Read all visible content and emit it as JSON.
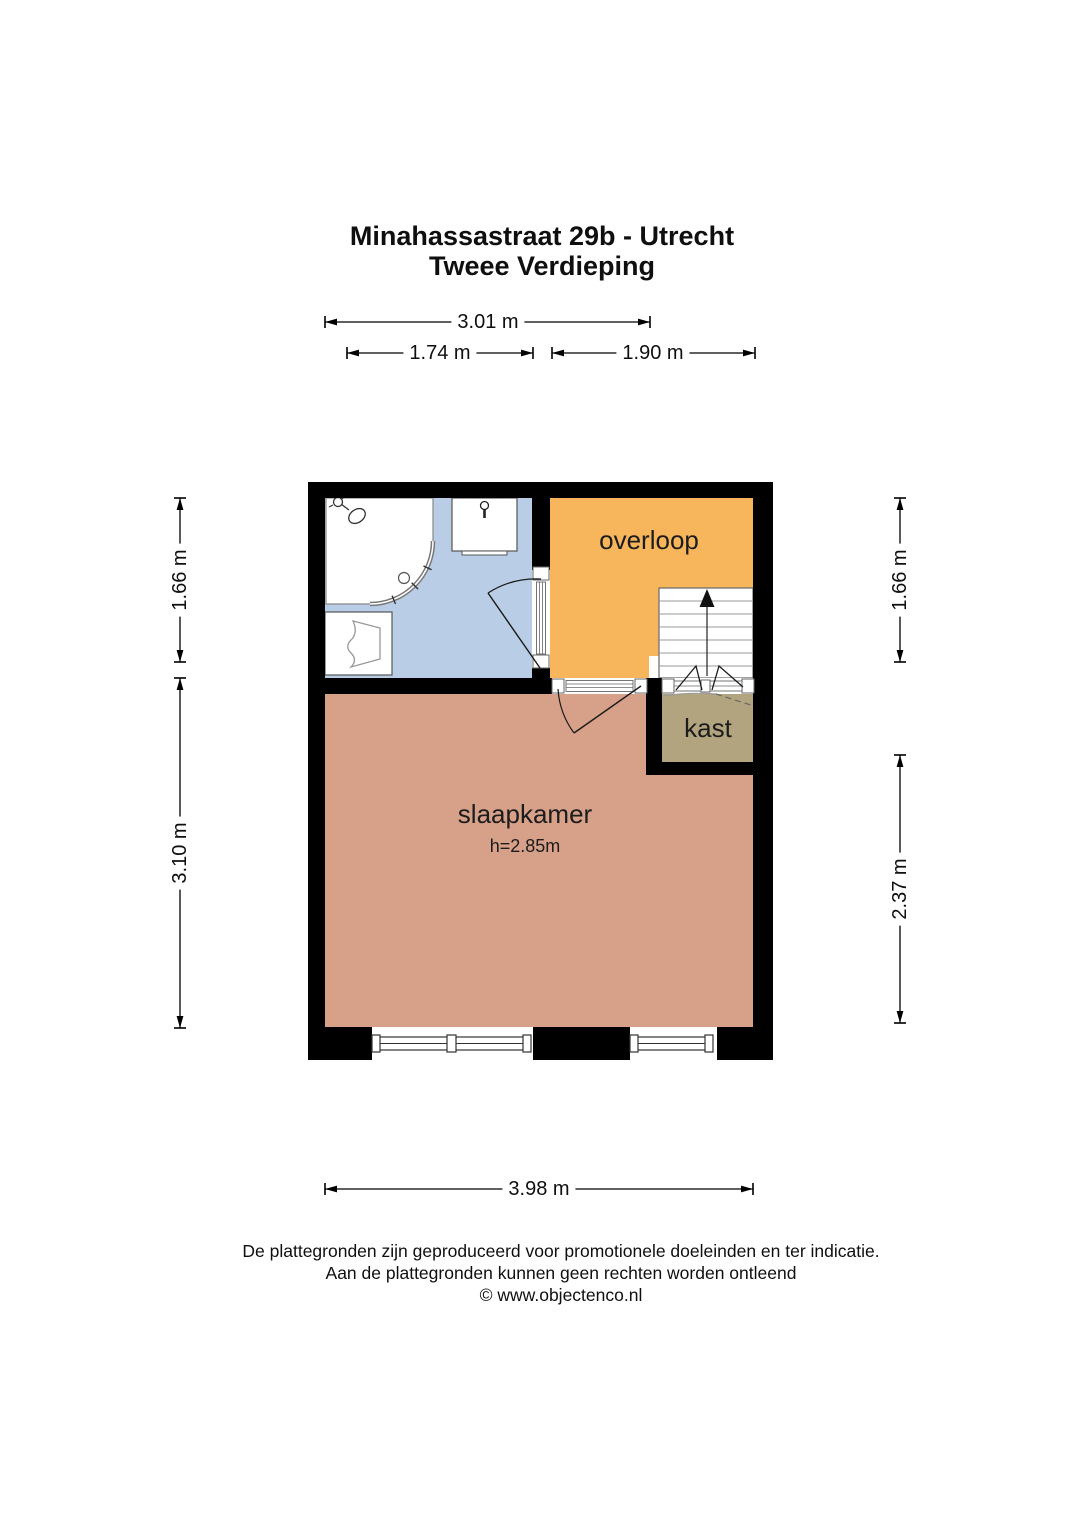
{
  "title": {
    "line1": "Minahassastraat 29b - Utrecht",
    "line2": "Tweee Verdieping"
  },
  "dimensions": {
    "top_total": "3.01 m",
    "top_left": "1.74 m",
    "top_right": "1.90 m",
    "left_upper": "1.66 m",
    "left_lower": "3.10 m",
    "right_upper": "1.66 m",
    "right_lower": "2.37 m",
    "bottom_total": "3.98 m"
  },
  "rooms": {
    "overloop": {
      "label": "overloop",
      "color": "#f7b65c"
    },
    "badkamer": {
      "color": "#b9cde6"
    },
    "slaapkamer": {
      "label": "slaapkamer",
      "height_note": "h=2.85m",
      "color": "#d7a089"
    },
    "kast": {
      "label": "kast",
      "color": "#b2a47f"
    }
  },
  "colors": {
    "wall": "#000000",
    "background": "#ffffff"
  },
  "footer": {
    "line1": "De plattegronden zijn geproduceerd voor promotionele doeleinden en ter indicatie.",
    "line2": "Aan de plattegronden kunnen geen rechten worden ontleend",
    "line3": "© www.objectenco.nl"
  }
}
